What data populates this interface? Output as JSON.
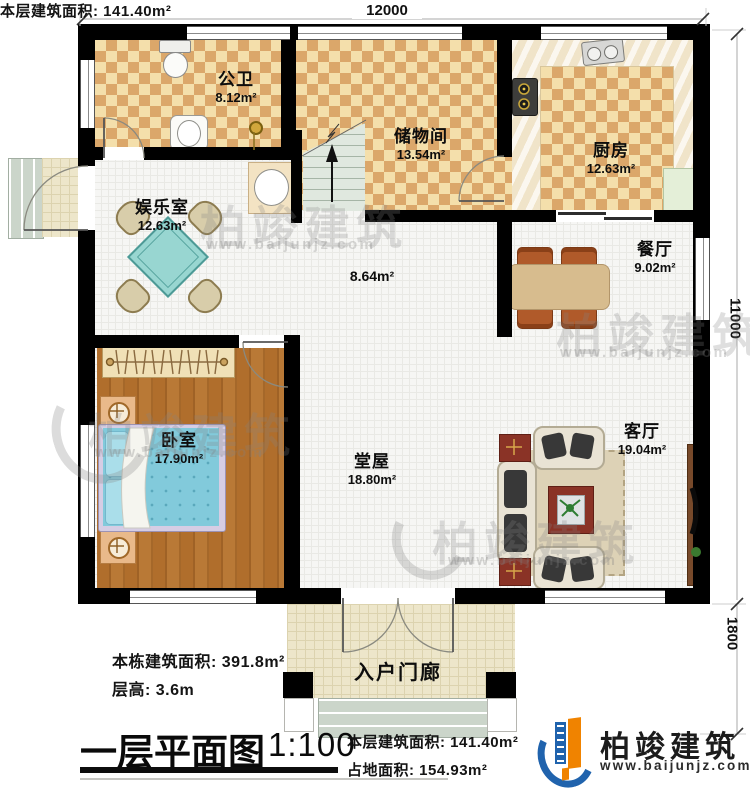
{
  "dimensions": {
    "top": "12000",
    "right_main": "11000",
    "right_porch": "1800"
  },
  "rooms": {
    "bathroom": {
      "name": "公卫",
      "area": "8.12m²"
    },
    "storage": {
      "name": "储物间",
      "area": "13.54m²"
    },
    "kitchen": {
      "name": "厨房",
      "area": "12.63m²"
    },
    "entertainment": {
      "name": "娱乐室",
      "area": "12.63m²"
    },
    "hallway": {
      "area": "8.64m²"
    },
    "dining": {
      "name": "餐厅",
      "area": "9.02m²"
    },
    "bedroom": {
      "name": "卧室",
      "area": "17.90m²"
    },
    "hall": {
      "name": "堂屋",
      "area": "18.80m²"
    },
    "living": {
      "name": "客厅",
      "area": "19.04m²"
    },
    "porch": {
      "name": "入户门廊"
    }
  },
  "annotations": {
    "building_total": "本栋建筑面积: 391.8m²",
    "floor_height": "层高: 3.6m",
    "title": "一层平面图",
    "scale": "1:100",
    "floor_area": "本层建筑面积: 141.40m²",
    "footprint": "占地面积: 154.93m²"
  },
  "branding": {
    "logo_text": "柏竣建筑",
    "logo_url": "www.baijunjz.com"
  },
  "watermark": {
    "text": "柏竣建筑",
    "url": "www.baijunjz.com"
  }
}
